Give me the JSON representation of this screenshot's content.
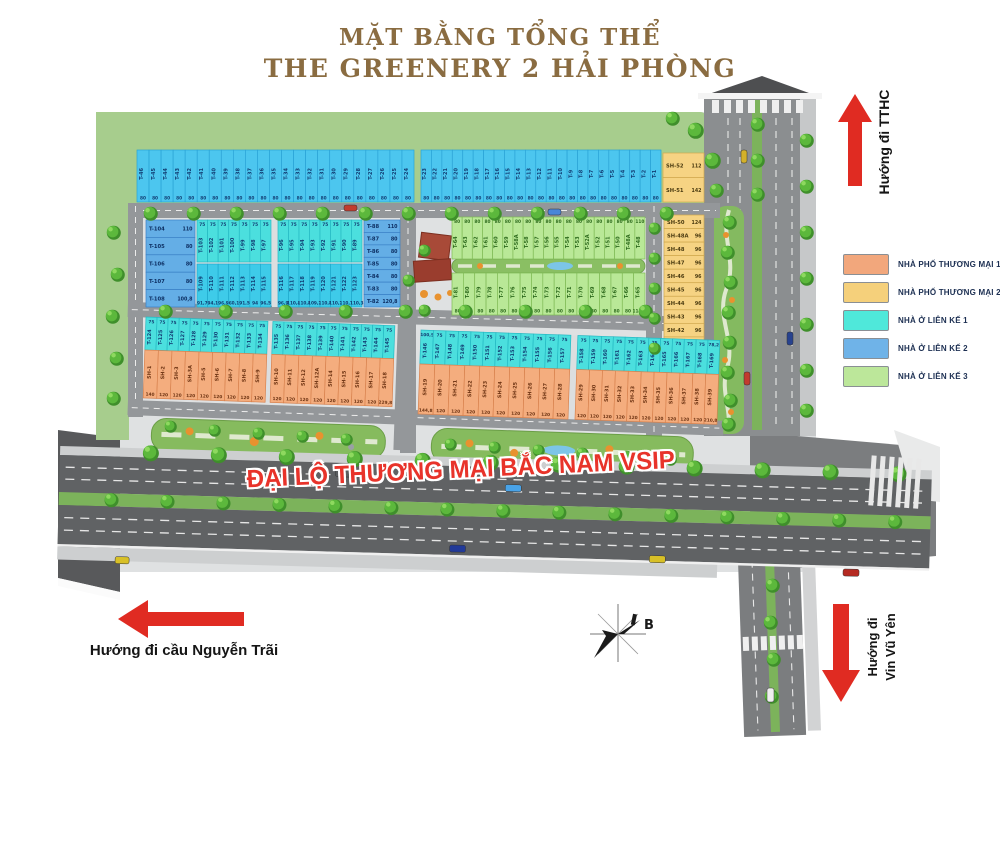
{
  "title": {
    "line1": "MẶT BẰNG TỔNG THỂ",
    "line2": "THE GREENERY 2 HẢI PHÒNG"
  },
  "legend": {
    "items": [
      {
        "label": "NHÀ PHỐ THƯƠNG MẠI 1",
        "color": "#f2a77c"
      },
      {
        "label": "NHÀ PHỐ THƯƠNG MẠI 2",
        "color": "#f5d07b"
      },
      {
        "label": "NHÀ Ở LIÊN KẾ 1",
        "color": "#4fe8da"
      },
      {
        "label": "NHÀ Ở LIÊN KẾ 2",
        "color": "#6fb3e8"
      },
      {
        "label": "NHÀ Ở LIÊN KẾ 3",
        "color": "#bce79a"
      }
    ]
  },
  "road_label": "ĐẠI LỘ THƯƠNG MẠI BẮC NAM VSIP",
  "directions": {
    "tthc": "Hướng đi TTHC",
    "nguyen_trai": "Hướng đi cầu Nguyễn Trãi",
    "vin_line1": "Hướng đi",
    "vin_line2": "Vin Vũ Yên"
  },
  "compass": {
    "label": "B"
  },
  "map": {
    "palette": {
      "lienke1": "#4bdfde",
      "lienke1_dark": "#3ecbe9",
      "lienke1_sky": "#4cc6ef",
      "lienke2": "#64aee6",
      "lienke3": "#b9e897",
      "shophouse1": "#f4ad7e",
      "shophouse2": "#f6d383"
    },
    "blocks": [
      {
        "id": "top_row_west",
        "category": "lienke1_sky",
        "lots": [
          [
            "T-46",
            "80"
          ],
          [
            "T-45",
            "80"
          ],
          [
            "T-44",
            "80"
          ],
          [
            "T-43",
            "80"
          ],
          [
            "T-42",
            "80"
          ],
          [
            "T-41",
            "80"
          ],
          [
            "T-40",
            "80"
          ],
          [
            "T-39",
            "80"
          ],
          [
            "T-38",
            "80"
          ],
          [
            "T-37",
            "80"
          ],
          [
            "T-36",
            "80"
          ],
          [
            "T-35",
            "80"
          ],
          [
            "T-34",
            "80"
          ],
          [
            "T-33",
            "80"
          ],
          [
            "T-32",
            "80"
          ],
          [
            "T-31",
            "80"
          ],
          [
            "T-30",
            "80"
          ],
          [
            "T-29",
            "80"
          ],
          [
            "T-28",
            "80"
          ],
          [
            "T-27",
            "80"
          ],
          [
            "T-26",
            "80"
          ],
          [
            "T-25",
            "80"
          ],
          [
            "T-24",
            "80"
          ]
        ]
      },
      {
        "id": "top_row_east",
        "category": "lienke1_sky",
        "lots": [
          [
            "T-23",
            "80"
          ],
          [
            "T-22",
            "80"
          ],
          [
            "T-21",
            "80"
          ],
          [
            "T-20",
            "80"
          ],
          [
            "T-19",
            "80"
          ],
          [
            "T-18",
            "80"
          ],
          [
            "T-17",
            "80"
          ],
          [
            "T-16",
            "80"
          ],
          [
            "T-15",
            "80"
          ],
          [
            "T-14",
            "80"
          ],
          [
            "T-13",
            "80"
          ],
          [
            "T-12",
            "80"
          ],
          [
            "T-11",
            "80"
          ],
          [
            "T-10",
            "80"
          ],
          [
            "T-9",
            "80"
          ],
          [
            "T-8",
            "80"
          ],
          [
            "T-7",
            "80"
          ],
          [
            "T-6",
            "80"
          ],
          [
            "T-5",
            "80"
          ],
          [
            "T-4",
            "80"
          ],
          [
            "T-3",
            "80"
          ],
          [
            "T-2",
            "80"
          ],
          [
            "T-1",
            "80"
          ]
        ]
      },
      {
        "id": "sh_top",
        "category": "shophouse2",
        "lots": [
          [
            "SH-52",
            "112"
          ],
          [
            "SH-51",
            "142"
          ]
        ]
      },
      {
        "id": "a_west_col",
        "category": "lienke2",
        "lots": [
          [
            "T-104",
            "110"
          ],
          [
            "T-105",
            "80"
          ],
          [
            "T-106",
            "80"
          ],
          [
            "T-107",
            "80"
          ],
          [
            "T-108",
            "100,8"
          ]
        ]
      },
      {
        "id": "a_row1_w",
        "category": "lienke1",
        "lots": [
          [
            "T-103",
            "75"
          ],
          [
            "T-102",
            "75"
          ],
          [
            "T-101",
            "75"
          ],
          [
            "T-100",
            "75"
          ],
          [
            "T-99",
            "75"
          ],
          [
            "T-98",
            "75"
          ],
          [
            "T-97",
            "75"
          ]
        ]
      },
      {
        "id": "a_row1_e",
        "category": "lienke1",
        "lots": [
          [
            "T-96",
            "75"
          ],
          [
            "T-95",
            "75"
          ],
          [
            "T-94",
            "75"
          ],
          [
            "T-93",
            "75"
          ],
          [
            "T-92",
            "75"
          ],
          [
            "T-91",
            "75"
          ],
          [
            "T-90",
            "75"
          ],
          [
            "T-89",
            "75"
          ]
        ]
      },
      {
        "id": "a_row2_w",
        "category": "lienke1_dark",
        "lots": [
          [
            "T-109",
            "91,7"
          ],
          [
            "T-110",
            "94,1"
          ],
          [
            "T-111",
            "96,9"
          ],
          [
            "T-112",
            "60,1"
          ],
          [
            "T-113",
            "91,5"
          ],
          [
            "T-114",
            "94"
          ],
          [
            "T-115",
            "96,5"
          ]
        ]
      },
      {
        "id": "a_row2_e",
        "category": "lienke1_dark",
        "lots": [
          [
            "T-116",
            "96,9"
          ],
          [
            "T-117",
            "110,4"
          ],
          [
            "T-118",
            "110,8"
          ],
          [
            "T-119",
            "109,2"
          ],
          [
            "T-120",
            "110,8"
          ],
          [
            "T-121",
            "110,2"
          ],
          [
            "T-122",
            "110,7"
          ],
          [
            "T-123",
            "110,3"
          ]
        ]
      },
      {
        "id": "a_east_col",
        "category": "lienke2",
        "lots": [
          [
            "T-88",
            "110"
          ],
          [
            "T-87",
            "80"
          ],
          [
            "T-86",
            "80"
          ],
          [
            "T-85",
            "80"
          ],
          [
            "T-84",
            "80"
          ],
          [
            "T-83",
            "80"
          ],
          [
            "T-82",
            "120,8"
          ]
        ]
      },
      {
        "id": "b_row1",
        "category": "lienke3",
        "lots": [
          [
            "T-64",
            "80"
          ],
          [
            "T-63",
            "80"
          ],
          [
            "T-62",
            "80"
          ],
          [
            "T-61",
            "80"
          ],
          [
            "T-60",
            "80"
          ],
          [
            "T-59",
            "80"
          ],
          [
            "T-58A",
            "80"
          ],
          [
            "T-58",
            "80"
          ],
          [
            "T-57",
            "80"
          ],
          [
            "T-56",
            "80"
          ],
          [
            "T-55",
            "80"
          ],
          [
            "T-54",
            "80"
          ],
          [
            "T-53",
            "80"
          ],
          [
            "T-52A",
            "80"
          ],
          [
            "T-52",
            "80"
          ],
          [
            "T-51",
            "80"
          ],
          [
            "T-50",
            "80"
          ],
          [
            "T-48A",
            "80"
          ],
          [
            "T-48",
            "110"
          ]
        ]
      },
      {
        "id": "b_row2",
        "category": "lienke3",
        "lots": [
          [
            "T-81",
            "80"
          ],
          [
            "T-80",
            "80"
          ],
          [
            "T-79",
            "80"
          ],
          [
            "T-78",
            "80"
          ],
          [
            "T-77",
            "80"
          ],
          [
            "T-76",
            "80"
          ],
          [
            "T-75",
            "80"
          ],
          [
            "T-74",
            "80"
          ],
          [
            "T-73",
            "80"
          ],
          [
            "T-72",
            "80"
          ],
          [
            "T-71",
            "80"
          ],
          [
            "T-70",
            "80"
          ],
          [
            "T-69",
            "80"
          ],
          [
            "T-68",
            "80"
          ],
          [
            "T-67",
            "80"
          ],
          [
            "T-66",
            "80"
          ],
          [
            "T-65",
            "114,2"
          ]
        ]
      },
      {
        "id": "sh_east_col",
        "category": "shophouse2",
        "lots": [
          [
            "SH-50",
            "124"
          ],
          [
            "SH-48A",
            "96"
          ],
          [
            "SH-48",
            "96"
          ],
          [
            "SH-47",
            "96"
          ],
          [
            "SH-46",
            "96"
          ],
          [
            "SH-45",
            "96"
          ],
          [
            "SH-44",
            "96"
          ],
          [
            "SH-43",
            "96"
          ],
          [
            "SH-42",
            "96"
          ],
          [
            "SH-41",
            "96"
          ],
          [
            "SH-40",
            "96"
          ]
        ]
      },
      {
        "id": "d_row1_w",
        "category": "lienke1",
        "lots": [
          [
            "T-124",
            "75"
          ],
          [
            "T-125",
            "75"
          ],
          [
            "T-126",
            "75"
          ],
          [
            "T-127",
            "75"
          ],
          [
            "T-128",
            "75"
          ],
          [
            "T-129",
            "75"
          ],
          [
            "T-130",
            "75"
          ],
          [
            "T-131",
            "75"
          ],
          [
            "T-132",
            "75"
          ],
          [
            "T-133",
            "75"
          ],
          [
            "T-134",
            "75"
          ]
        ]
      },
      {
        "id": "d_row1_e",
        "category": "lienke1",
        "lots": [
          [
            "T-135",
            "75"
          ],
          [
            "T-136",
            "75"
          ],
          [
            "T-137",
            "75"
          ],
          [
            "T-138",
            "75"
          ],
          [
            "T-139",
            "75"
          ],
          [
            "T-140",
            "75"
          ],
          [
            "T-141",
            "75"
          ],
          [
            "T-142",
            "75"
          ],
          [
            "T-143",
            "75"
          ],
          [
            "T-144",
            "75"
          ],
          [
            "T-145",
            "75"
          ]
        ]
      },
      {
        "id": "d_row2_w",
        "category": "shophouse1",
        "lots": [
          [
            "SH-1",
            "140"
          ],
          [
            "SH-2",
            "120"
          ],
          [
            "SH-3",
            "120"
          ],
          [
            "SH-3A",
            "120"
          ],
          [
            "SH-5",
            "120"
          ],
          [
            "SH-6",
            "120"
          ],
          [
            "SH-7",
            "120"
          ],
          [
            "SH-8",
            "120"
          ],
          [
            "SH-9",
            "120"
          ]
        ]
      },
      {
        "id": "d_row2_e",
        "category": "shophouse1",
        "lots": [
          [
            "SH-10",
            "120"
          ],
          [
            "SH-11",
            "120"
          ],
          [
            "SH-12",
            "120"
          ],
          [
            "SH-12A",
            "120"
          ],
          [
            "SH-14",
            "120"
          ],
          [
            "SH-15",
            "120"
          ],
          [
            "SH-16",
            "120"
          ],
          [
            "SH-17",
            "120"
          ],
          [
            "SH-18",
            "229,8"
          ]
        ]
      },
      {
        "id": "e_row1_w",
        "category": "lienke1",
        "lots": [
          [
            "T-146",
            "100,5"
          ],
          [
            "T-147",
            "75"
          ],
          [
            "T-148",
            "75"
          ],
          [
            "T-149",
            "75"
          ],
          [
            "T-150",
            "75"
          ],
          [
            "T-151",
            "75"
          ],
          [
            "T-152",
            "75"
          ],
          [
            "T-153",
            "75"
          ],
          [
            "T-154",
            "75"
          ],
          [
            "T-155",
            "75"
          ],
          [
            "T-156",
            "75"
          ],
          [
            "T-157",
            "75"
          ]
        ]
      },
      {
        "id": "e_row1_e",
        "category": "lienke1",
        "lots": [
          [
            "T-158",
            "75"
          ],
          [
            "T-159",
            "75"
          ],
          [
            "T-160",
            "75"
          ],
          [
            "T-161",
            "75"
          ],
          [
            "T-162",
            "75"
          ],
          [
            "T-163",
            "75"
          ],
          [
            "T-164",
            "75"
          ],
          [
            "T-165",
            "75"
          ],
          [
            "T-166",
            "75"
          ],
          [
            "T-167",
            "75"
          ],
          [
            "T-168",
            "75"
          ],
          [
            "T-169",
            "78,2"
          ]
        ]
      },
      {
        "id": "e_row2_w",
        "category": "shophouse1",
        "lots": [
          [
            "SH-19",
            "144,8"
          ],
          [
            "SH-20",
            "120"
          ],
          [
            "SH-21",
            "120"
          ],
          [
            "SH-22",
            "120"
          ],
          [
            "SH-23",
            "120"
          ],
          [
            "SH-24",
            "120"
          ],
          [
            "SH-25",
            "120"
          ],
          [
            "SH-26",
            "120"
          ],
          [
            "SH-27",
            "120"
          ],
          [
            "SH-28",
            "120"
          ]
        ]
      },
      {
        "id": "e_row2_e",
        "category": "shophouse1",
        "lots": [
          [
            "SH-29",
            "120"
          ],
          [
            "SH-30",
            "120"
          ],
          [
            "SH-31",
            "120"
          ],
          [
            "SH-32",
            "120"
          ],
          [
            "SH-33",
            "120"
          ],
          [
            "SH-34",
            "120"
          ],
          [
            "SH-35",
            "120"
          ],
          [
            "SH-36",
            "120"
          ],
          [
            "SH-37",
            "120"
          ],
          [
            "SH-38",
            "120"
          ],
          [
            "SH-39",
            "210,8"
          ]
        ]
      }
    ]
  }
}
